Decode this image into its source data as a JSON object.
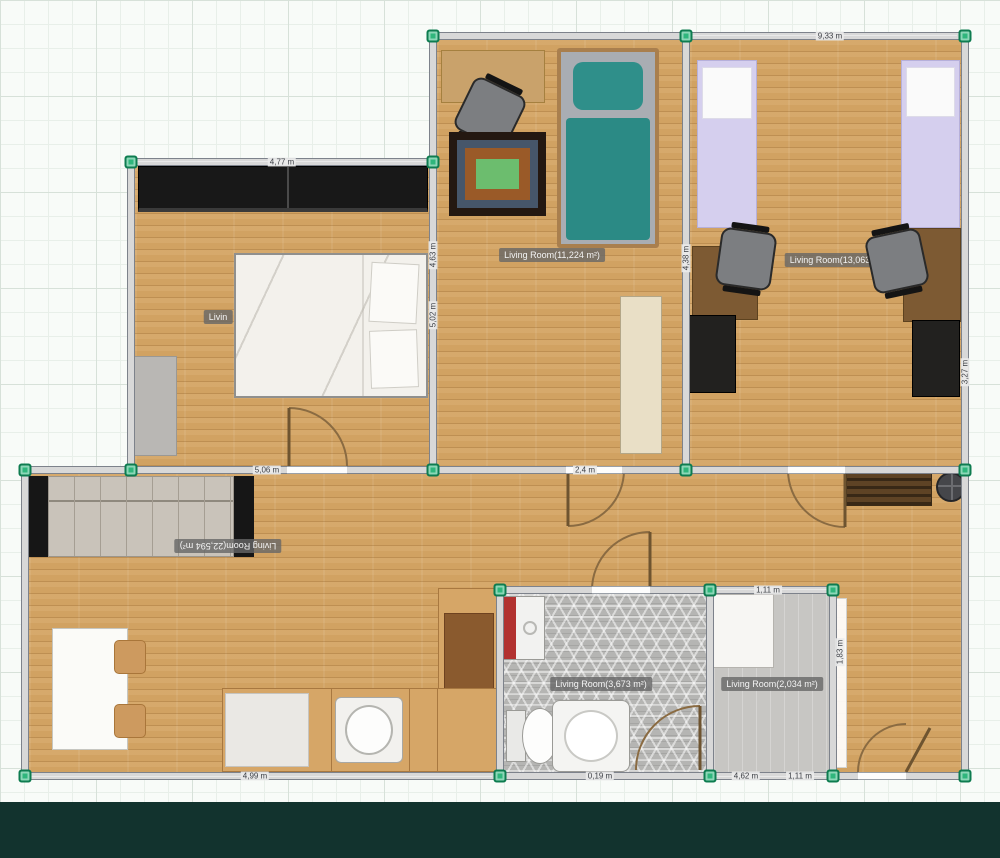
{
  "canvas": {
    "bottom_bar_color": "#12332e",
    "grid_background": "#f8fbf8",
    "handle_color": "#2fb67c",
    "wood_color": "#d1a262"
  },
  "labels": {
    "bedroom_partial": "Livin",
    "living_mid": "Living Room(11,224 m²)",
    "living_right": "Living Room(13,063 m²)",
    "living_main_flipped": "Living Room(22,594 m²)",
    "bathroom": "Living Room(3,673 m²)",
    "small_room": "Living Room(2,034 m²)"
  },
  "dimensions": {
    "top": "9,33 m",
    "bedroom_top": "4,77 m",
    "mid_left": "5,06 m",
    "mid_right": "2,4 m",
    "bottom_left": "4,99 m",
    "bottom_mid": "0,19 m",
    "bottom_right_a": "4,62 m",
    "bottom_right_b": "1,11 m",
    "small_room_top": "1,11 m",
    "v_mid_upper": "4,63 m",
    "v_mid_lower": "5,02 m",
    "v_divider": "4,38 m",
    "v_right_wall": "3,27 m",
    "v_small_room": "1,83 m"
  }
}
